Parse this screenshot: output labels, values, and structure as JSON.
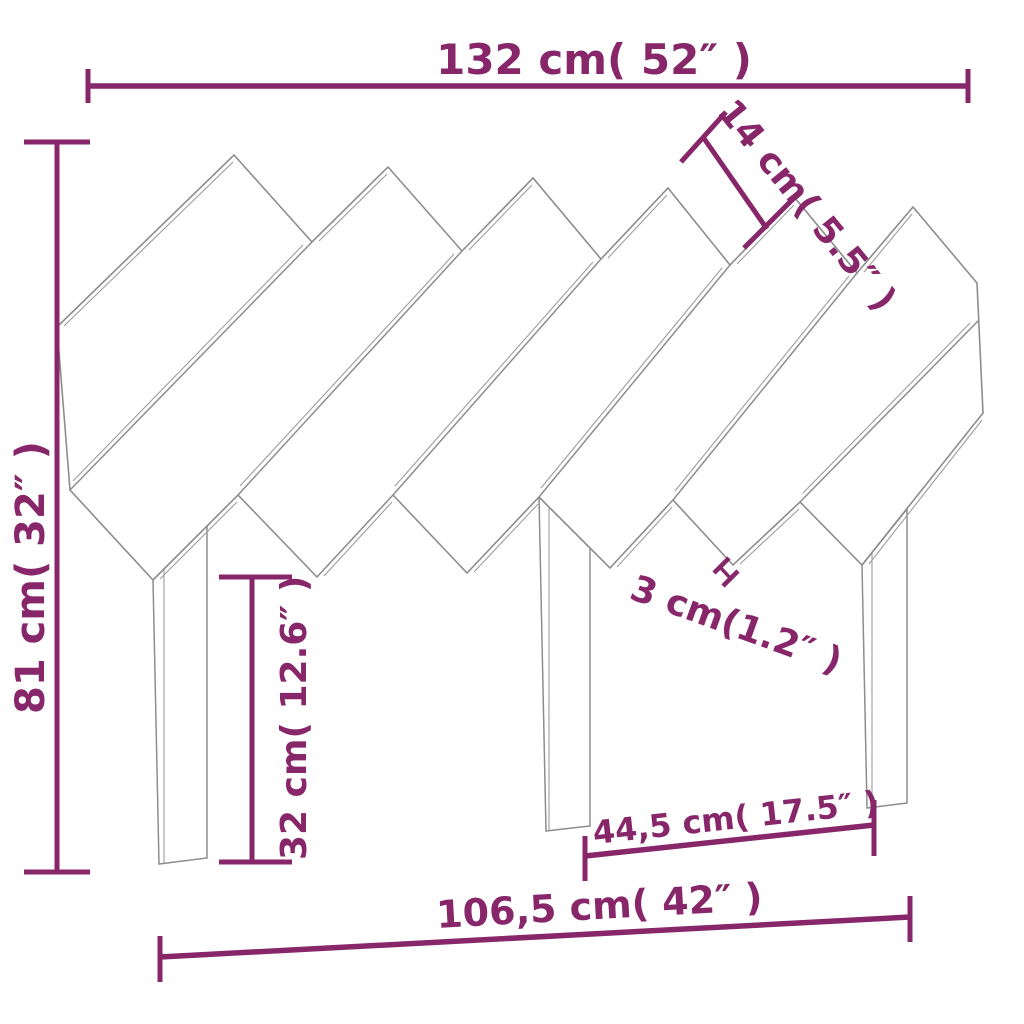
{
  "diagram": {
    "subject": "bed headboard with diagonal wooden slats and three legs, front technical drawing",
    "style": "line drawing with dimension annotations",
    "colors": {
      "dimension_annotation": "#88266a",
      "drawing_outline": "#8d8d8d",
      "background": "#ffffff"
    },
    "dimensions": {
      "overall_width": {
        "label": "132 cm( 52″ )",
        "orientation": "horizontal",
        "position": "top"
      },
      "slat_width": {
        "label": "14 cm( 5.5″ )",
        "orientation": "diagonal-45deg",
        "position": "upper-right"
      },
      "overall_height": {
        "label": "81 cm( 32″ )",
        "orientation": "vertical",
        "position": "left"
      },
      "leg_height": {
        "label": "32 cm( 12.6″ )",
        "orientation": "vertical",
        "position": "lower-left"
      },
      "slat_thickness": {
        "label": "3 cm(1.2″ )",
        "orientation": "diagonal-20deg",
        "position": "center-right"
      },
      "inner_leg_span": {
        "label": "44,5 cm( 17.5″ )",
        "orientation": "horizontal-tilted",
        "position": "bottom-right"
      },
      "base_width": {
        "label": "106,5 cm( 42″ )",
        "orientation": "horizontal-tilted",
        "position": "bottom"
      }
    }
  }
}
